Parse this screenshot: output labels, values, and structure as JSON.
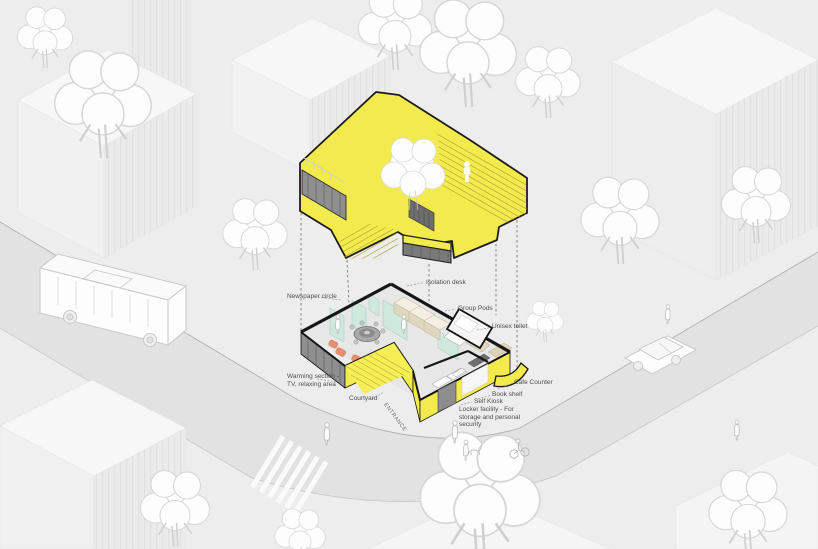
{
  "palette": {
    "background": "#ecedec",
    "building_yellow": "#f3eb4e",
    "outline_black": "#161616",
    "partition_mint": "#cfe9dc",
    "seat_orange": "#e98f70",
    "pod_beige": "#e0d7bf",
    "road_grey": "#e2e2e2",
    "label_grey": "#4e4e4e"
  },
  "annotations": {
    "newspaper_circle": "Newspaper circle",
    "isolation_desk": "Isolation desk",
    "group_pods": "Group Pods",
    "unisex_toilet": "Unisex toilet",
    "cafe_counter": "Cafe Counter",
    "book_shelf": "Book shelf",
    "self_kiosk": "Self Kiosk",
    "locker_facility": "Locker facility - For storage and personal security",
    "warming_section": "Warming section - TV, relaxing area",
    "courtyard": "Courtyard",
    "entrance": "ENTRANCE"
  }
}
